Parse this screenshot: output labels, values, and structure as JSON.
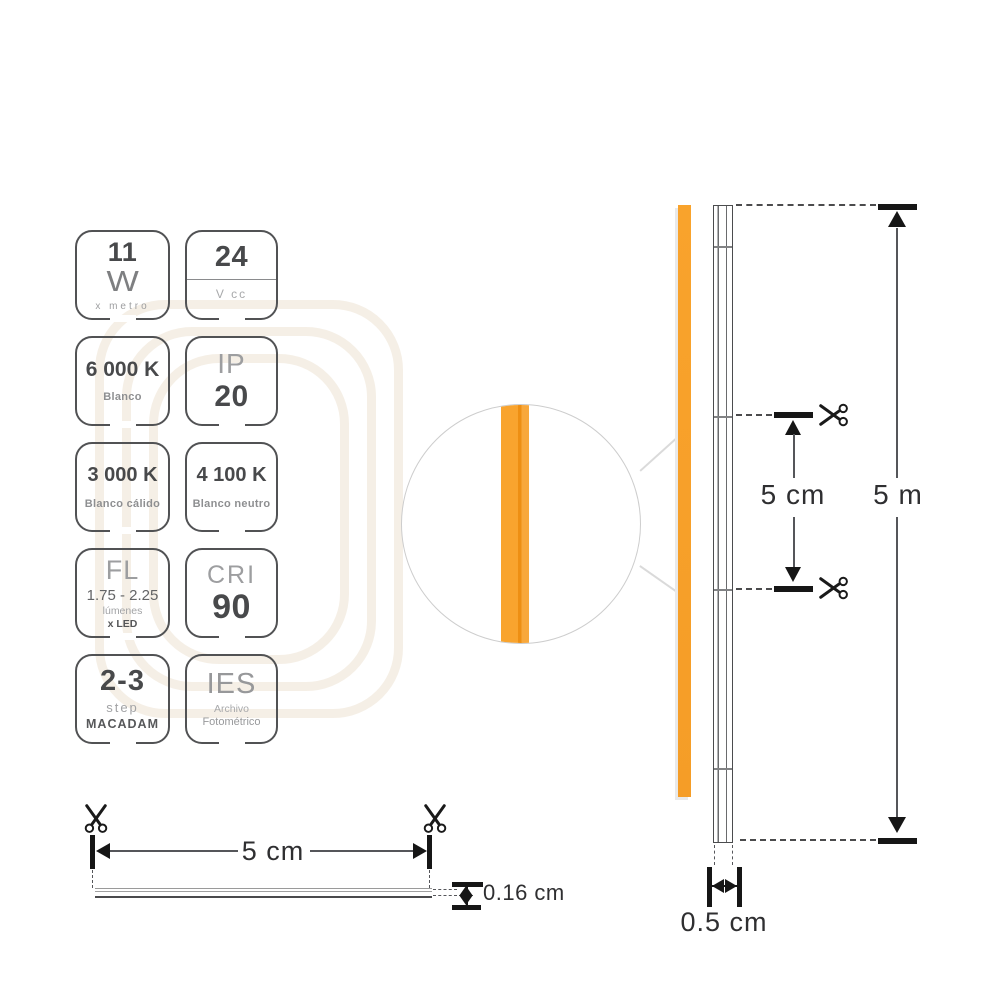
{
  "badges": {
    "power": {
      "value": "11",
      "unit": "W",
      "caption": "x metro"
    },
    "voltage": {
      "value": "24",
      "caption": "V cc"
    },
    "cct_6000": {
      "value": "6 000 K",
      "caption": "Blanco"
    },
    "ip": {
      "label": "IP",
      "value": "20"
    },
    "cct_3000": {
      "value": "3 000 K",
      "caption": "Blanco cálido"
    },
    "cct_4100": {
      "value": "4 100 K",
      "caption": "Blanco neutro"
    },
    "flux": {
      "label": "FL",
      "value": "1.75 - 2.25",
      "caption": "lúmenes",
      "caption2": "x LED"
    },
    "cri": {
      "label": "CRI",
      "value": "90"
    },
    "macadam": {
      "value": "2-3",
      "caption": "step",
      "caption2": "MACADAM"
    },
    "ies": {
      "label": "IES",
      "caption": "Archivo",
      "caption2": "Fotométrico"
    }
  },
  "dimensions": {
    "cut_length": "5 cm",
    "total_length": "5 m",
    "strip_width": "0.5 cm",
    "strip_thickness": "0.16 cm",
    "cut_length_side": "5 cm"
  },
  "icons": {
    "scissors": "✂"
  },
  "colors": {
    "strip_orange": "#F9A32C",
    "strip_orange_dark": "#EE8F13",
    "dimension_black": "#161616",
    "outline_gray": "#515254",
    "text_dark": "#48494B",
    "text_light": "#9D9EA0",
    "watermark_beige": "#F1EADD"
  }
}
